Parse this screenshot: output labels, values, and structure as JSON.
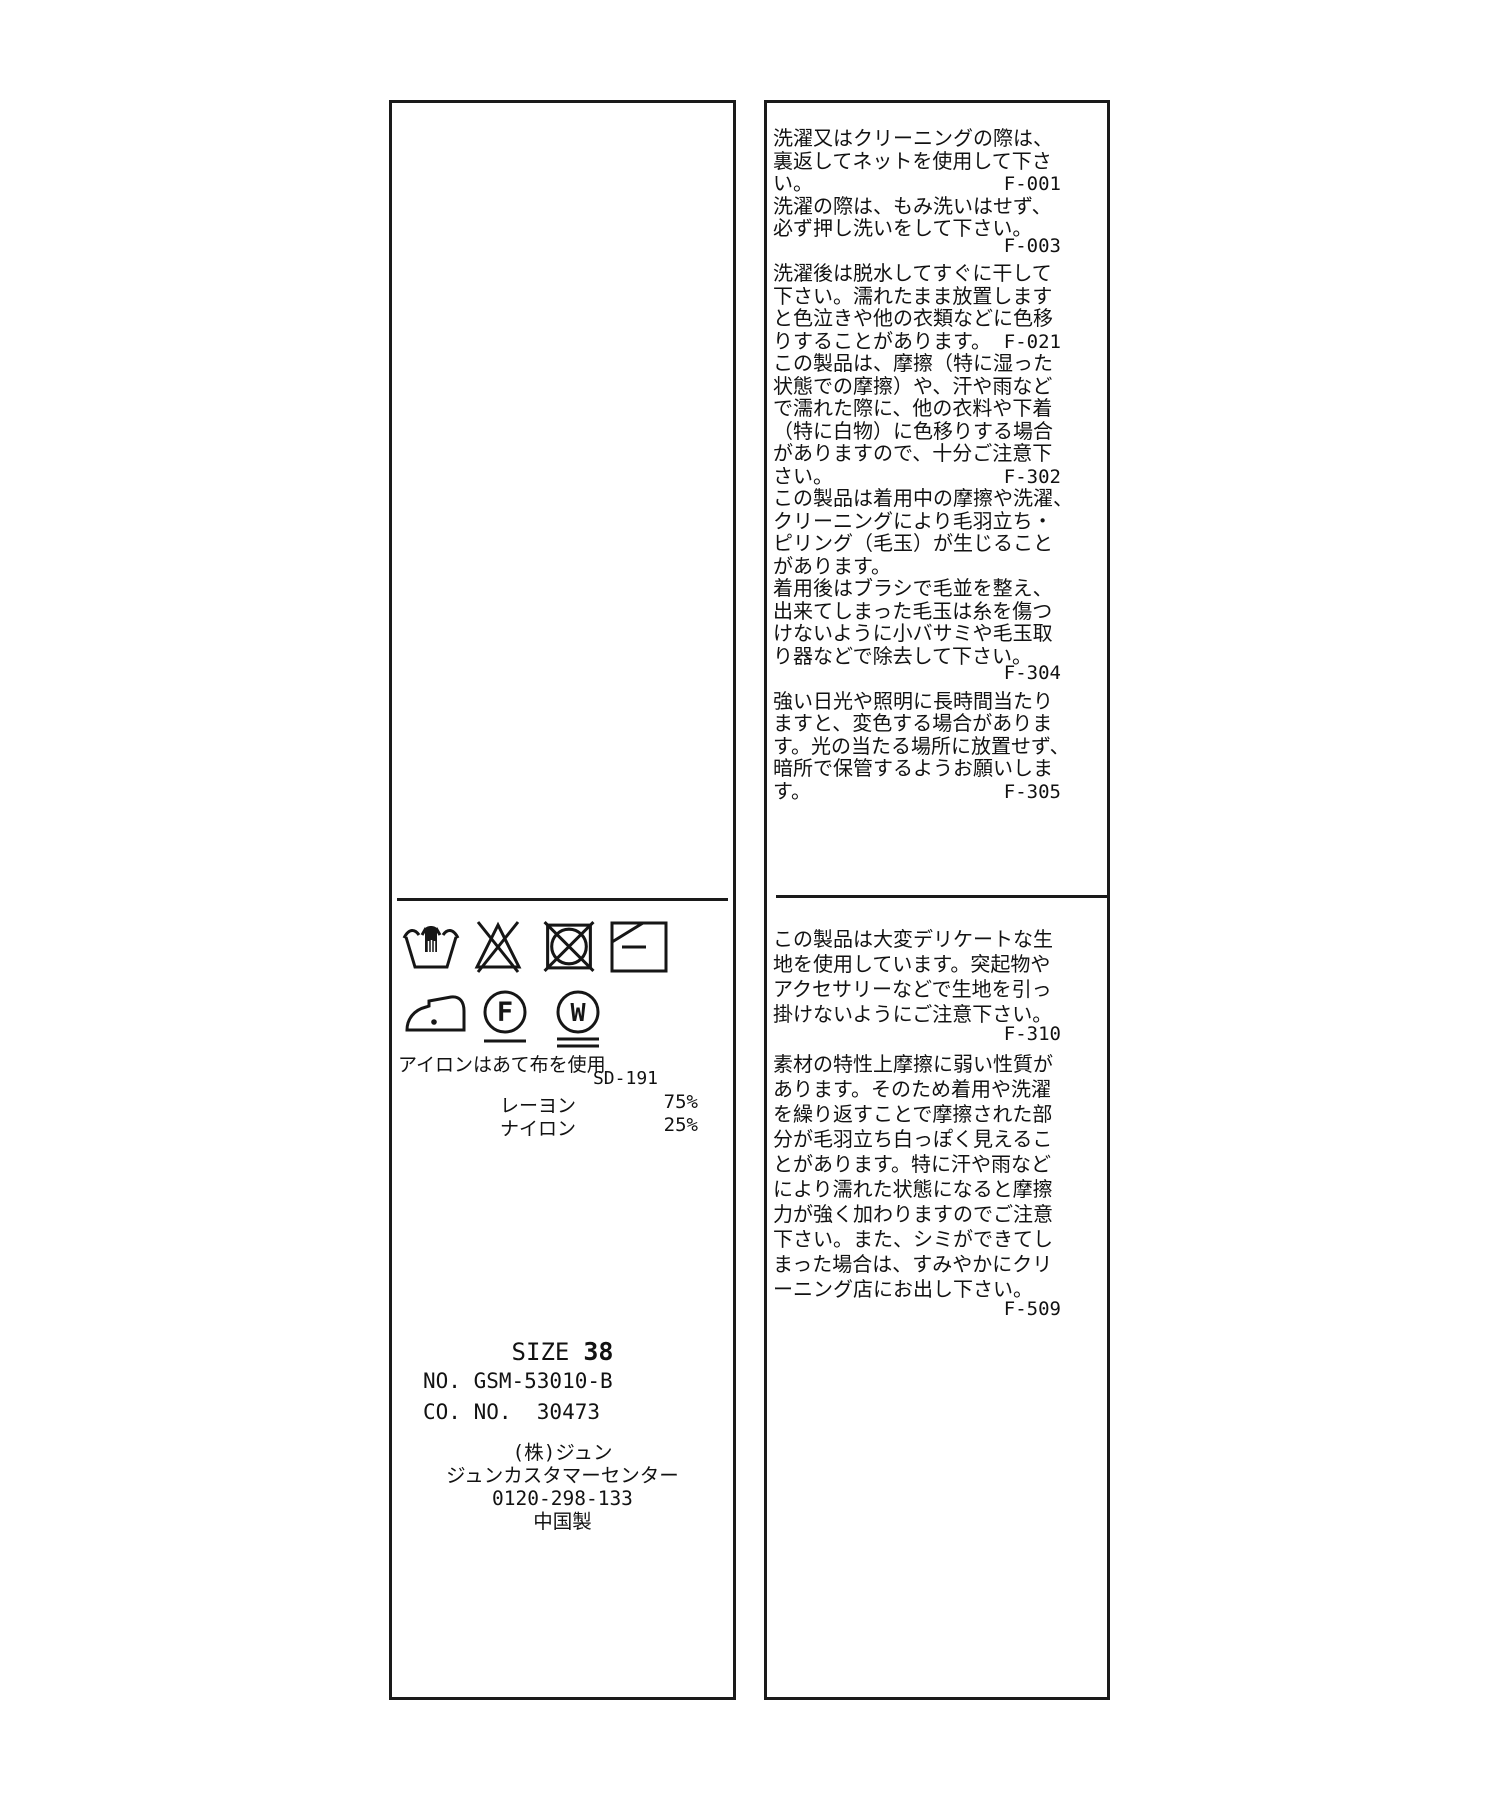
{
  "left_panel": {
    "care_symbols": {
      "row1": [
        "hand-wash",
        "do-not-bleach",
        "do-not-tumble-dry",
        "dry-flat-in-shade"
      ],
      "row2": [
        "iron-low-heat",
        "dry-clean-petroleum-gentle",
        "wet-clean-very-gentle"
      ],
      "icon_letters": {
        "f": "F",
        "w": "W"
      }
    },
    "iron_note": "アイロンはあて布を使用",
    "quality_code": "SD-191",
    "composition": [
      {
        "material": "レーヨン",
        "percent": "75%"
      },
      {
        "material": "ナイロン",
        "percent": "25%"
      }
    ],
    "size_label": "SIZE",
    "size_value": "38",
    "product_no": "NO. GSM-53010-B",
    "company_no": "CO. NO.  30473",
    "company_lines": [
      "(株)ジュン",
      "ジュンカスタマーセンター",
      "0120-298-133",
      "中国製"
    ]
  },
  "right_panel": {
    "block1": [
      {
        "t": "洗濯又はクリーニングの際は、",
        "c": ""
      },
      {
        "t": "裏返してネットを使用して下さ",
        "c": ""
      },
      {
        "t": "い。",
        "c": "F-001"
      },
      {
        "t": "洗濯の際は、もみ洗いはせず、",
        "c": ""
      },
      {
        "t": "必ず押し洗いをして下さい。",
        "c": ""
      },
      {
        "t": "",
        "c": "F-003"
      },
      {
        "t": "洗濯後は脱水してすぐに干して",
        "c": ""
      },
      {
        "t": "下さい。濡れたまま放置します",
        "c": ""
      },
      {
        "t": "と色泣きや他の衣類などに色移",
        "c": ""
      },
      {
        "t": "りすることがあります。",
        "c": "F-021"
      },
      {
        "t": "この製品は、摩擦（特に湿った",
        "c": ""
      },
      {
        "t": "状態での摩擦）や、汗や雨など",
        "c": ""
      },
      {
        "t": "で濡れた際に、他の衣料や下着",
        "c": ""
      },
      {
        "t": "（特に白物）に色移りする場合",
        "c": ""
      },
      {
        "t": "がありますので、十分ご注意下",
        "c": ""
      },
      {
        "t": "さい。",
        "c": "F-302"
      },
      {
        "t": "この製品は着用中の摩擦や洗濯、",
        "c": ""
      },
      {
        "t": "クリーニングにより毛羽立ち・",
        "c": ""
      },
      {
        "t": "ピリング（毛玉）が生じること",
        "c": ""
      },
      {
        "t": "があります。",
        "c": ""
      },
      {
        "t": "着用後はブラシで毛並を整え、",
        "c": ""
      },
      {
        "t": "出来てしまった毛玉は糸を傷つ",
        "c": ""
      },
      {
        "t": "けないように小バサミや毛玉取",
        "c": ""
      },
      {
        "t": "り器などで除去して下さい。",
        "c": ""
      },
      {
        "t": "",
        "c": "F-304"
      },
      {
        "t": "強い日光や照明に長時間当たり",
        "c": ""
      },
      {
        "t": "ますと、変色する場合がありま",
        "c": ""
      },
      {
        "t": "す。光の当たる場所に放置せず、",
        "c": ""
      },
      {
        "t": "暗所で保管するようお願いしま",
        "c": ""
      },
      {
        "t": "す。",
        "c": "F-305"
      }
    ],
    "block2": [
      {
        "t": "この製品は大変デリケートな生",
        "c": ""
      },
      {
        "t": "地を使用しています。突起物や",
        "c": ""
      },
      {
        "t": "アクセサリーなどで生地を引っ",
        "c": ""
      },
      {
        "t": "掛けないようにご注意下さい。",
        "c": ""
      },
      {
        "t": "",
        "c": "F-310"
      },
      {
        "t": "素材の特性上摩擦に弱い性質が",
        "c": ""
      },
      {
        "t": "あります。そのため着用や洗濯",
        "c": ""
      },
      {
        "t": "を繰り返すことで摩擦された部",
        "c": ""
      },
      {
        "t": "分が毛羽立ち白っぽく見えるこ",
        "c": ""
      },
      {
        "t": "とがあります。特に汗や雨など",
        "c": ""
      },
      {
        "t": "により濡れた状態になると摩擦",
        "c": ""
      },
      {
        "t": "力が強く加わりますのでご注意",
        "c": ""
      },
      {
        "t": "下さい。また、シミができてし",
        "c": ""
      },
      {
        "t": "まった場合は、すみやかにクリ",
        "c": ""
      },
      {
        "t": "ーニング店にお出し下さい。",
        "c": ""
      },
      {
        "t": "",
        "c": "F-509"
      }
    ]
  }
}
